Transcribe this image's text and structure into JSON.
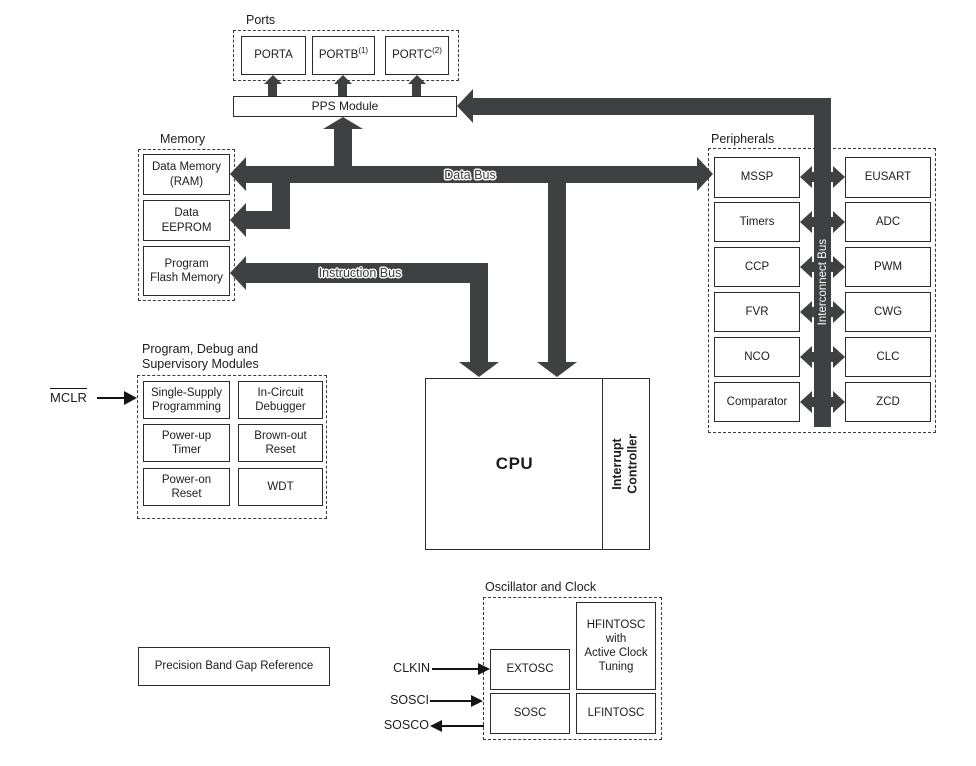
{
  "colors": {
    "bus": "#3f4042",
    "line": "#2b2b2b",
    "background": "#ffffff",
    "text": "#1c1c1c"
  },
  "ports": {
    "title": "Ports",
    "items": [
      {
        "label": "PORTA",
        "sup": ""
      },
      {
        "label": "PORTB",
        "sup": "(1)"
      },
      {
        "label": "PORTC",
        "sup": "(2)"
      }
    ]
  },
  "pps": {
    "label": "PPS Module"
  },
  "memory": {
    "title": "Memory",
    "ram": "Data Memory\n(RAM)",
    "eeprom": "Data\nEEPROM",
    "flash": "Program\nFlash Memory"
  },
  "buses": {
    "data": "Data Bus",
    "instruction": "Instruction Bus",
    "interconnect": "Interconnect Bus"
  },
  "cpu": {
    "label": "CPU",
    "interrupt": "Interrupt\nController"
  },
  "peripherals": {
    "title": "Peripherals",
    "left": [
      "MSSP",
      "Timers",
      "CCP",
      "FVR",
      "NCO",
      "Comparator"
    ],
    "right": [
      "EUSART",
      "ADC",
      "PWM",
      "CWG",
      "CLC",
      "ZCD"
    ]
  },
  "debug": {
    "title": "Program, Debug and\nSupervisory Modules",
    "mclr": "MCLR",
    "left": [
      "Single-Supply\nProgramming",
      "Power-up\nTimer",
      "Power-on\nReset"
    ],
    "right": [
      "In-Circuit\nDebugger",
      "Brown-out\nReset",
      "WDT"
    ]
  },
  "bandgap": {
    "label": "Precision Band Gap Reference"
  },
  "oscillator": {
    "title": "Oscillator and Clock",
    "extosc": "EXTOSC",
    "hfintosc": "HFINTOSC\nwith\nActive Clock\nTuning",
    "sosc": "SOSC",
    "lfintosc": "LFINTOSC",
    "pins": {
      "clkin": "CLKIN",
      "sosci": "SOSCI",
      "sosco": "SOSCO"
    }
  }
}
